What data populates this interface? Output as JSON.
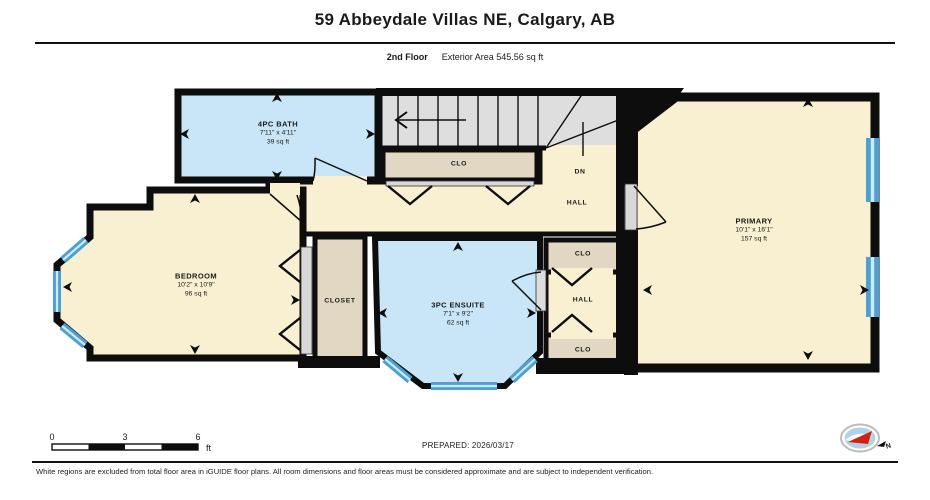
{
  "header": {
    "title": "59 Abbeydale Villas NE, Calgary, AB",
    "floor": "2nd Floor",
    "exterior_area": "Exterior Area 545.56 sq ft"
  },
  "rooms": {
    "bath": {
      "name": "4PC BATH",
      "dims": "7'11\" x 4'11\"",
      "area": "39 sq ft"
    },
    "bedroom": {
      "name": "BEDROOM",
      "dims": "10'2\" x 10'9\"",
      "area": "96 sq ft"
    },
    "ensuite": {
      "name": "3PC ENSUITE",
      "dims": "7'1\" x 9'2\"",
      "area": "62 sq ft"
    },
    "primary": {
      "name": "PRIMARY",
      "dims": "10'1\" x 16'1\"",
      "area": "157 sq ft"
    },
    "closet": {
      "name": "CLOSET"
    },
    "clo_stairs": {
      "name": "CLO"
    },
    "clo_top": {
      "name": "CLO"
    },
    "clo_bottom": {
      "name": "CLO"
    },
    "hall_upper": {
      "name": "HALL"
    },
    "hall_lower": {
      "name": "HALL"
    },
    "stairs": {
      "direction": "DN"
    }
  },
  "scale_bar": {
    "tick0": "0",
    "tick3": "3",
    "tick6": "6",
    "unit": "ft"
  },
  "footer": {
    "prepared": "PREPARED: 2026/03/17",
    "disclaimer": "White regions are excluded from total floor area in iGUIDE floor plans. All room dimensions and floor areas must be considered approximate and are subject to independent verification."
  },
  "compass": {
    "north_label": "N"
  },
  "colors": {
    "room_cream": "#F8F0D0",
    "room_blue": "#C8E6F8",
    "closet_tan": "#E1D7C2",
    "stairs_gray": "#DEDEDE",
    "window_blue": "#4BA0D4",
    "window_light": "#CFE9F7",
    "wall_black": "#0D0D0D",
    "compass_red": "#D32011",
    "compass_blue": "#AFD3E8"
  }
}
